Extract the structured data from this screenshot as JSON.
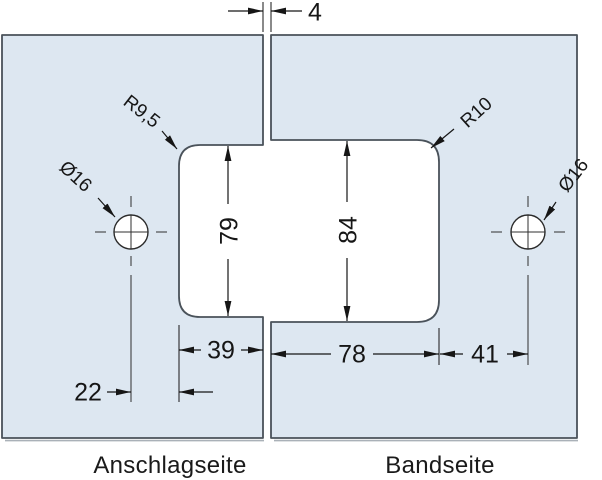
{
  "colors": {
    "panel_fill": "#dde7f1",
    "panel_stroke": "#4a525a",
    "dimension_line": "#161616"
  },
  "gap": {
    "value": "4"
  },
  "left_panel": {
    "label": "Anschlagseite",
    "radius_label": "R9,5",
    "hole_label": "Ø16",
    "notch_height": "79",
    "notch_depth": "39",
    "hole_offset": "22"
  },
  "right_panel": {
    "label": "Bandseite",
    "radius_label": "R10",
    "hole_label": "Ø16",
    "notch_height": "84",
    "notch_depth": "78",
    "hole_offset": "41"
  }
}
